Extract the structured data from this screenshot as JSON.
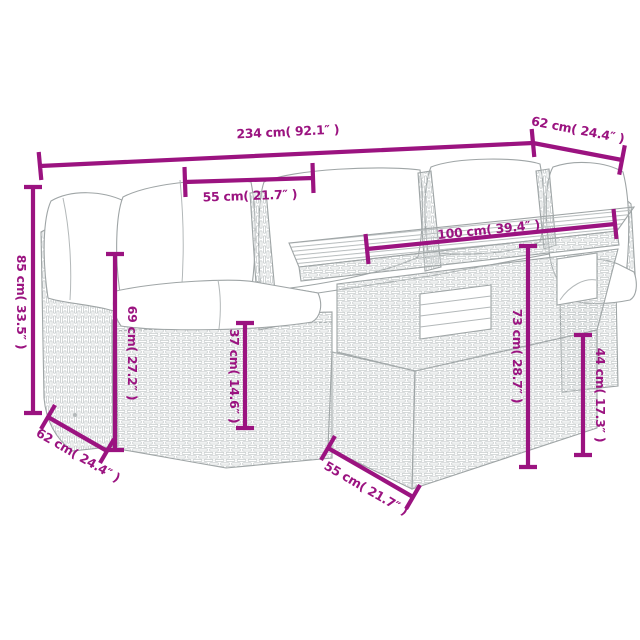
{
  "subject": "Rattan garden lounge set with table — product dimension diagram",
  "accent_color": "#9B1380",
  "artwork_line_color": "#9FA5A6",
  "background_color": "#FFFFFF",
  "dims": {
    "total_width": "234 cm( 92.1″ )",
    "seat_depth_top": "62 cm( 24.4″ )",
    "seat_width": "55 cm( 21.7″ )",
    "table_length": "100 cm( 39.4″ )",
    "back_height": "85 cm( 33.5″ )",
    "arm_height": "69 cm( 27.2″ )",
    "seat_height": "37 cm( 14.6″ )",
    "table_height": "73 cm( 28.7″ )",
    "table_base_height": "44 cm( 17.3″ )",
    "seat_depth_bottom": "62 cm( 24.4″ )",
    "table_depth": "55 cm( 21.7″ )"
  }
}
